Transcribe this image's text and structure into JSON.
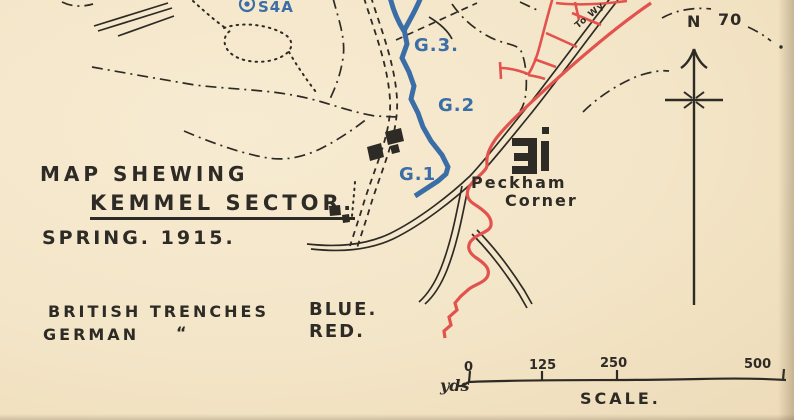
{
  "map": {
    "title_line1": "MAP SHEWING",
    "title_line2": "KEMMEL SECTOR.",
    "title_line3": "SPRING. 1915.",
    "legend": {
      "row1_label": "BRITISH TRENCHES",
      "row1_value": "BLUE.",
      "row2_label": "GERMAN",
      "row2_ditto": "“",
      "row2_value": "RED."
    },
    "labels": {
      "strongpoint": "S4A",
      "trench_g3": "G.3.",
      "trench_g2": "G.2",
      "trench_g1": "G.1",
      "place_line1": "Peckham",
      "place_line2": "Corner",
      "road_destination": "To Wy",
      "contour": "70",
      "north": "N"
    },
    "scale": {
      "unit": "yds",
      "ticks": [
        "0",
        "125",
        "250",
        "500"
      ],
      "caption": "SCALE."
    },
    "colors": {
      "paper": "#f3e5c7",
      "ink": "#2e2b26",
      "british_blue": "#3b6da6",
      "german_red": "#e2534e"
    }
  }
}
